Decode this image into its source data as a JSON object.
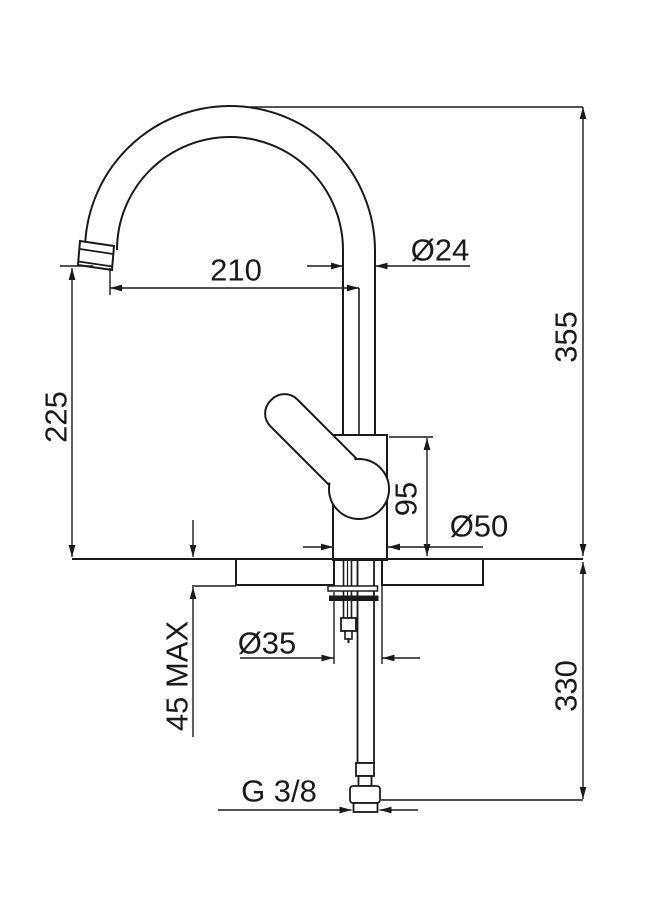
{
  "drawing": {
    "labels": {
      "total_height": "355",
      "hose_length": "330",
      "outlet_height": "225",
      "spout_reach": "210",
      "spout_diameter": "Ø24",
      "body_diameter": "Ø50",
      "hole_diameter": "Ø35",
      "body_height": "95",
      "deck_thickness_max": "45 MAX",
      "thread_size": "G 3/8"
    },
    "colors": {
      "line": "#1a1a1a",
      "background": "#ffffff"
    }
  }
}
